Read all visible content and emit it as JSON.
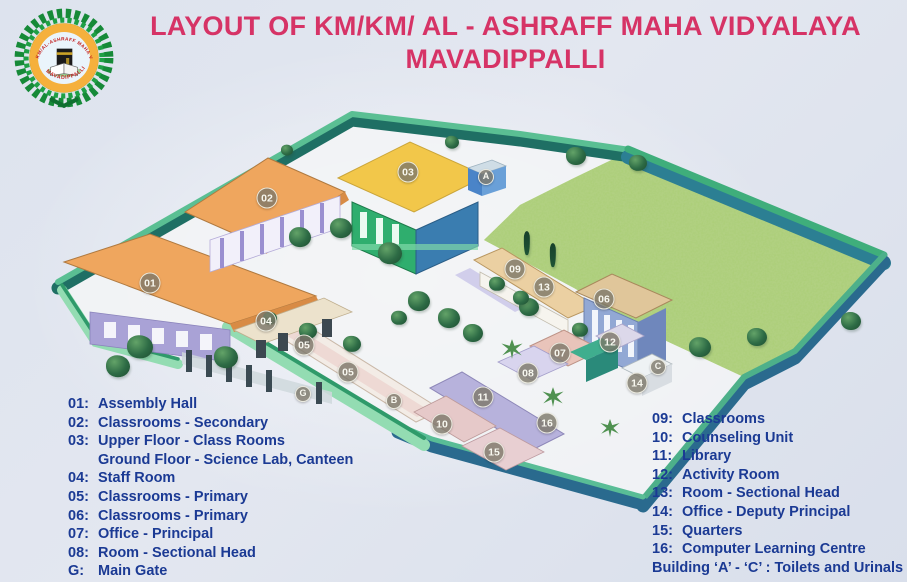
{
  "header": {
    "title_line1": "LAYOUT OF KM/KM/ AL - ASHRAFF MAHA VIDYALAYA",
    "title_line2": "MAVADIPPALLI"
  },
  "logo": {
    "arc_text_top": "KM/AL-ASHRAFF MAHA VIDYALAYA",
    "arc_text_bottom": "MAVADIPPALLI"
  },
  "legend": {
    "left": [
      {
        "num": "01:",
        "text": "Assembly Hall",
        "indent": false
      },
      {
        "num": "02:",
        "text": "Classrooms - Secondary",
        "indent": false
      },
      {
        "num": "03:",
        "text": "Upper Floor - Class Rooms",
        "indent": false
      },
      {
        "num": "",
        "text": "Ground Floor - Science Lab, Canteen",
        "indent": true
      },
      {
        "num": "04:",
        "text": "Staff Room",
        "indent": false
      },
      {
        "num": "05:",
        "text": "Classrooms - Primary",
        "indent": false
      },
      {
        "num": "06:",
        "text": "Classrooms - Primary",
        "indent": false
      },
      {
        "num": "07:",
        "text": "Office - Principal",
        "indent": false
      },
      {
        "num": "08:",
        "text": "Room - Sectional Head",
        "indent": false
      },
      {
        "num": "G:",
        "text": "Main Gate",
        "indent": false
      }
    ],
    "right": [
      {
        "num": "09:",
        "text": "Classrooms",
        "indent": false
      },
      {
        "num": "10:",
        "text": "Counseling Unit",
        "indent": false
      },
      {
        "num": "11:",
        "text": "Library",
        "indent": false
      },
      {
        "num": "12:",
        "text": "Activity Room",
        "indent": false
      },
      {
        "num": "13:",
        "text": "Room - Sectional Head",
        "indent": false
      },
      {
        "num": "14:",
        "text": "Office - Deputy Principal",
        "indent": false
      },
      {
        "num": "15:",
        "text": "Quarters",
        "indent": false
      },
      {
        "num": "16:",
        "text": "Computer Learning Centre",
        "indent": false
      },
      {
        "num": "",
        "text": "Building ‘A’ - ‘C’ : Toilets and Urinals",
        "indent": false
      }
    ]
  },
  "map": {
    "markers": [
      {
        "label": "01",
        "x": 150,
        "y": 283,
        "title": "Assembly Hall"
      },
      {
        "label": "02",
        "x": 267,
        "y": 198,
        "title": "Classrooms - Secondary"
      },
      {
        "label": "03",
        "x": 408,
        "y": 172,
        "title": "Upper Floor Class Rooms / Ground Floor Science Lab, Canteen"
      },
      {
        "label": "04",
        "x": 266,
        "y": 321,
        "title": "Staff Room"
      },
      {
        "label": "05",
        "x": 304,
        "y": 345,
        "title": "Classrooms - Primary"
      },
      {
        "label": "05",
        "x": 348,
        "y": 372,
        "title": "Classrooms - Primary"
      },
      {
        "label": "06",
        "x": 604,
        "y": 299,
        "title": "Classrooms - Primary"
      },
      {
        "label": "07",
        "x": 560,
        "y": 353,
        "title": "Office - Principal"
      },
      {
        "label": "08",
        "x": 528,
        "y": 373,
        "title": "Room - Sectional Head"
      },
      {
        "label": "09",
        "x": 515,
        "y": 269,
        "title": "Classrooms"
      },
      {
        "label": "10",
        "x": 442,
        "y": 424,
        "title": "Counseling Unit"
      },
      {
        "label": "11",
        "x": 483,
        "y": 397,
        "title": "Library"
      },
      {
        "label": "12",
        "x": 610,
        "y": 342,
        "title": "Activity Room"
      },
      {
        "label": "13",
        "x": 544,
        "y": 287,
        "title": "Room - Sectional Head"
      },
      {
        "label": "14",
        "x": 637,
        "y": 383,
        "title": "Office - Deputy Principal"
      },
      {
        "label": "15",
        "x": 494,
        "y": 452,
        "title": "Quarters"
      },
      {
        "label": "16",
        "x": 547,
        "y": 423,
        "title": "Computer Learning Centre"
      },
      {
        "label": "A",
        "x": 486,
        "y": 177,
        "letter": true,
        "title": "Toilets and Urinals"
      },
      {
        "label": "B",
        "x": 394,
        "y": 401,
        "letter": true,
        "title": "Toilets and Urinals"
      },
      {
        "label": "C",
        "x": 658,
        "y": 367,
        "letter": true,
        "title": "Toilets and Urinals"
      },
      {
        "label": "G",
        "x": 303,
        "y": 394,
        "letter": true,
        "title": "Main Gate"
      }
    ],
    "trees": [
      {
        "x": 140,
        "y": 347,
        "s": 26,
        "t": "round"
      },
      {
        "x": 118,
        "y": 366,
        "s": 24,
        "t": "round"
      },
      {
        "x": 226,
        "y": 357,
        "s": 24,
        "t": "round"
      },
      {
        "x": 300,
        "y": 237,
        "s": 22,
        "t": "round"
      },
      {
        "x": 341,
        "y": 228,
        "s": 22,
        "t": "round"
      },
      {
        "x": 390,
        "y": 253,
        "s": 24,
        "t": "round"
      },
      {
        "x": 419,
        "y": 301,
        "s": 22,
        "t": "round"
      },
      {
        "x": 449,
        "y": 318,
        "s": 22,
        "t": "round"
      },
      {
        "x": 473,
        "y": 333,
        "s": 20,
        "t": "round"
      },
      {
        "x": 308,
        "y": 331,
        "s": 18,
        "t": "round"
      },
      {
        "x": 352,
        "y": 344,
        "s": 18,
        "t": "round"
      },
      {
        "x": 399,
        "y": 318,
        "s": 16,
        "t": "round"
      },
      {
        "x": 270,
        "y": 318,
        "s": 14,
        "t": "round"
      },
      {
        "x": 529,
        "y": 307,
        "s": 20,
        "t": "round"
      },
      {
        "x": 576,
        "y": 156,
        "s": 20,
        "t": "round"
      },
      {
        "x": 638,
        "y": 163,
        "s": 18,
        "t": "round"
      },
      {
        "x": 700,
        "y": 347,
        "s": 22,
        "t": "round"
      },
      {
        "x": 757,
        "y": 337,
        "s": 20,
        "t": "round"
      },
      {
        "x": 851,
        "y": 321,
        "s": 20,
        "t": "round"
      },
      {
        "x": 497,
        "y": 284,
        "s": 16,
        "t": "round"
      },
      {
        "x": 521,
        "y": 298,
        "s": 16,
        "t": "round"
      },
      {
        "x": 580,
        "y": 330,
        "s": 16,
        "t": "round"
      },
      {
        "x": 452,
        "y": 142,
        "s": 14,
        "t": "round"
      },
      {
        "x": 287,
        "y": 150,
        "s": 12,
        "t": "round"
      },
      {
        "x": 527,
        "y": 243,
        "s": 14,
        "t": "tall"
      },
      {
        "x": 553,
        "y": 255,
        "s": 14,
        "t": "tall"
      },
      {
        "x": 512,
        "y": 349,
        "s": 22,
        "t": "palm"
      },
      {
        "x": 553,
        "y": 397,
        "s": 22,
        "t": "palm"
      },
      {
        "x": 610,
        "y": 428,
        "s": 20,
        "t": "palm"
      }
    ]
  },
  "palette": {
    "background": "#dde3ee",
    "title_text": "#d63366",
    "legend_text": "#1b3a94",
    "roof_orange": "#efa65e",
    "roof_yellow": "#f2c74a",
    "roof_tan": "#ebd0a2",
    "roof_pink": "#e9c4ba",
    "roof_lavender": "#b7b2dc",
    "building_green": "#2fae6e",
    "building_blue": "#8fa3d2",
    "wall_teal": "#1f6f64",
    "wall_mint": "#93dcb2",
    "field_wall_top": "#3aa97a",
    "field_wall_face": "#2c7f93",
    "bottom_wall": "#2a6a8e",
    "grass": "#bcd98b",
    "tree_green": "#2d6b45",
    "marker_fill": "#7c7769",
    "emblem_wreath": "#168a38",
    "emblem_ring": "#f5b03c",
    "emblem_text": "#c21f1f"
  }
}
